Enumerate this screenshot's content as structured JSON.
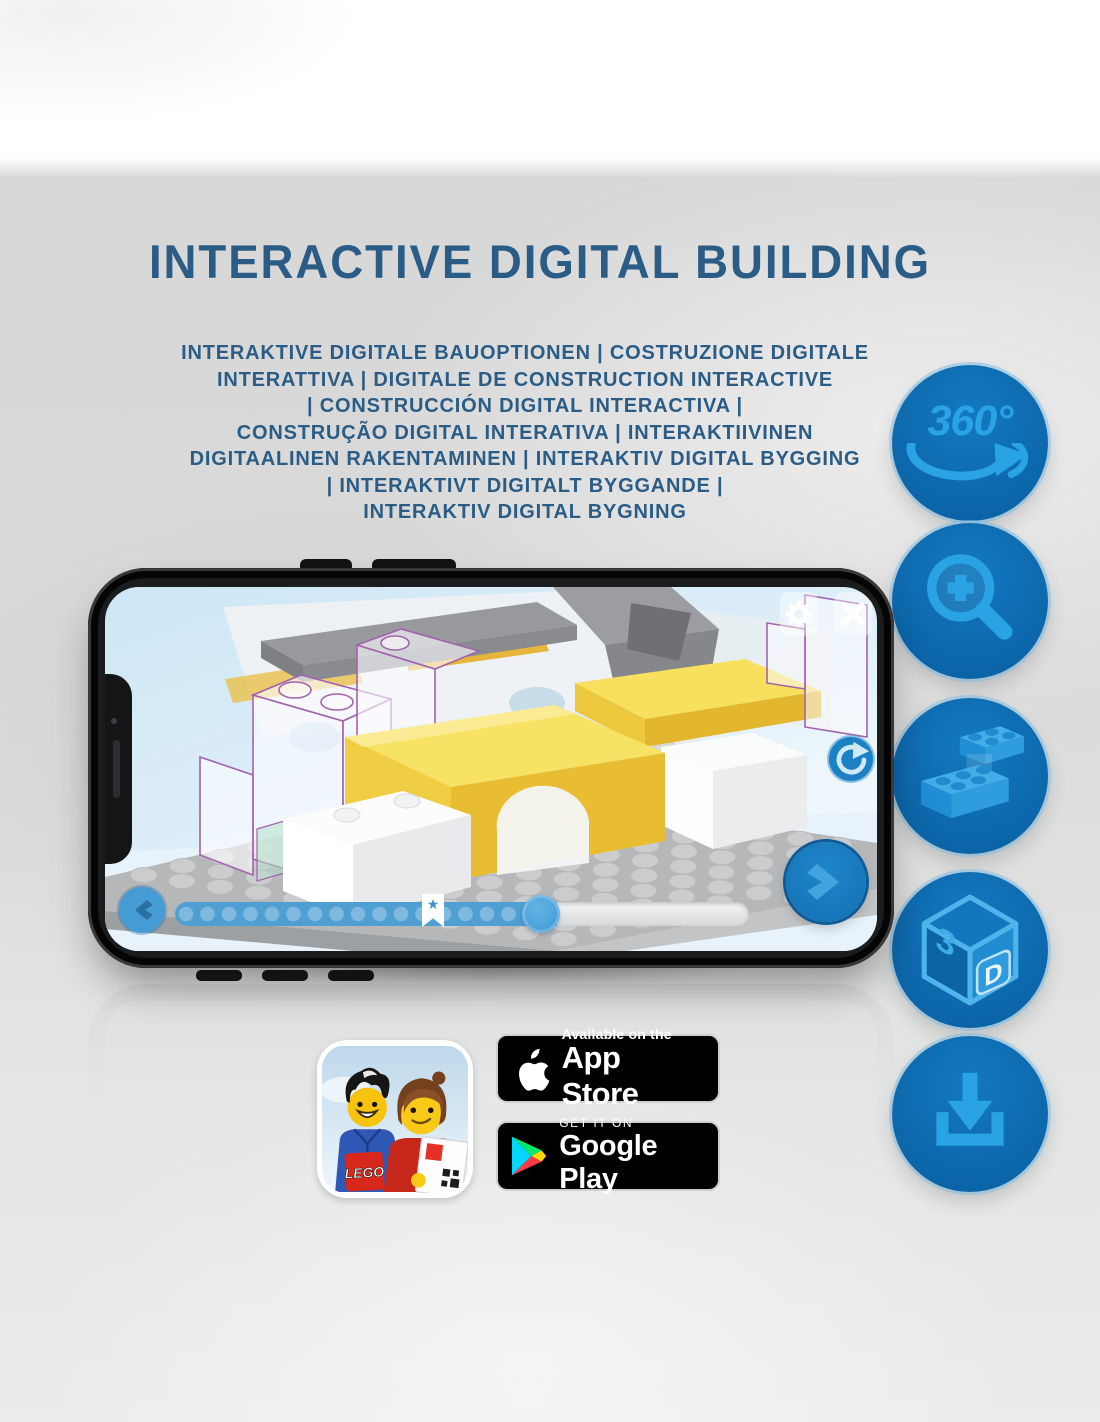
{
  "header": {
    "title": "INTERACTIVE DIGITAL BUILDING",
    "subtitle_lines": [
      "INTERAKTIVE DIGITALE BAUOPTIONEN | COSTRUZIONE DIGITALE",
      "INTERATTIVA | DIGITALE DE CONSTRUCTION INTERACTIVE",
      "| CONSTRUCCIÓN DIGITAL INTERACTIVA |",
      "CONSTRUÇÃO DIGITAL INTERATIVA | INTERAKTIIVINEN",
      "DIGITAALINEN RAKENTAMINEN | INTERAKTIV DIGITAL BYGGING",
      "| INTERAKTIVT DIGITALT BYGGANDE |",
      "INTERAKTIV DIGITAL BYGNING"
    ]
  },
  "feature_badges": {
    "circle_color": "#0e6db4",
    "icon_color": "#2aa3e4",
    "items": [
      {
        "icon": "360-rotation-icon",
        "label": "360°"
      },
      {
        "icon": "zoom-in-magnifier-icon"
      },
      {
        "icon": "stacking-bricks-icon"
      },
      {
        "icon": "3d-cube-icon",
        "cube_left_face": "3",
        "cube_right_face": "D"
      },
      {
        "icon": "download-icon"
      }
    ]
  },
  "phone_app": {
    "buttons": [
      "settings",
      "close",
      "rotate-view",
      "previous-step",
      "next-step"
    ],
    "progress": {
      "filled_percent": 66,
      "bookmark_percent": 45,
      "step_dots": 17
    }
  },
  "app_icon": {
    "logo_text": "LEGO"
  },
  "store_badges": {
    "app_store": {
      "tagline": "Available on the",
      "store_name": "App Store"
    },
    "google_play": {
      "tagline": "GET IT ON",
      "store_name": "Google Play"
    }
  },
  "colors": {
    "heading_blue": "#2a5c85",
    "deep_blue": "#0e6db4",
    "accent_blue": "#2aa3e4",
    "app_button_blue": "#1b7ec2",
    "brick_yellow": "#f3d24b"
  }
}
